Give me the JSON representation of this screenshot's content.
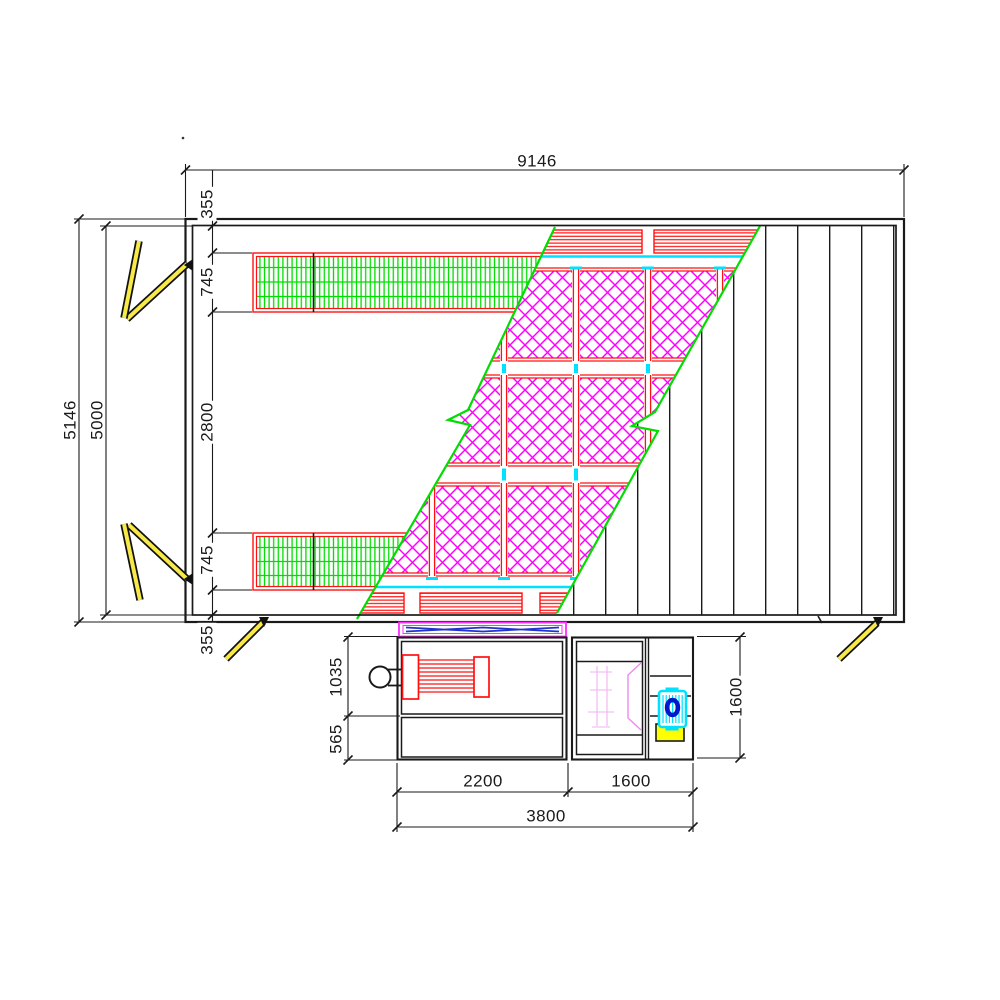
{
  "drawing": {
    "kind": "spray-booth floor plan (CAD)",
    "dimensions": {
      "overall_width": "9146",
      "outer_depth": "5146",
      "inner_depth": "5000",
      "edge_offset_top": "355",
      "side_grille_top": "745",
      "center_platform": "2800",
      "side_grille_bottom": "745",
      "edge_offset_bottom": "355",
      "fan_section_depth": "1035",
      "lower_section_depth": "565",
      "unit_depth": "1600",
      "fan_unit_width": "2200",
      "burner_unit_width": "1600",
      "unit_total_width": "3800"
    },
    "colors": {
      "line_black": "#1a1a1a",
      "grille_green": "#00dd00",
      "filter_magenta": "#ff00ff",
      "frame_red": "#ff1111",
      "water_cyan": "#00e0ff",
      "door_yellow": "#f7e948",
      "pump_blue": "#0018cc",
      "burner_pink": "#f2b2f2",
      "damper_magenta": "#ff2bff",
      "damper_blue": "#2233cc"
    }
  }
}
